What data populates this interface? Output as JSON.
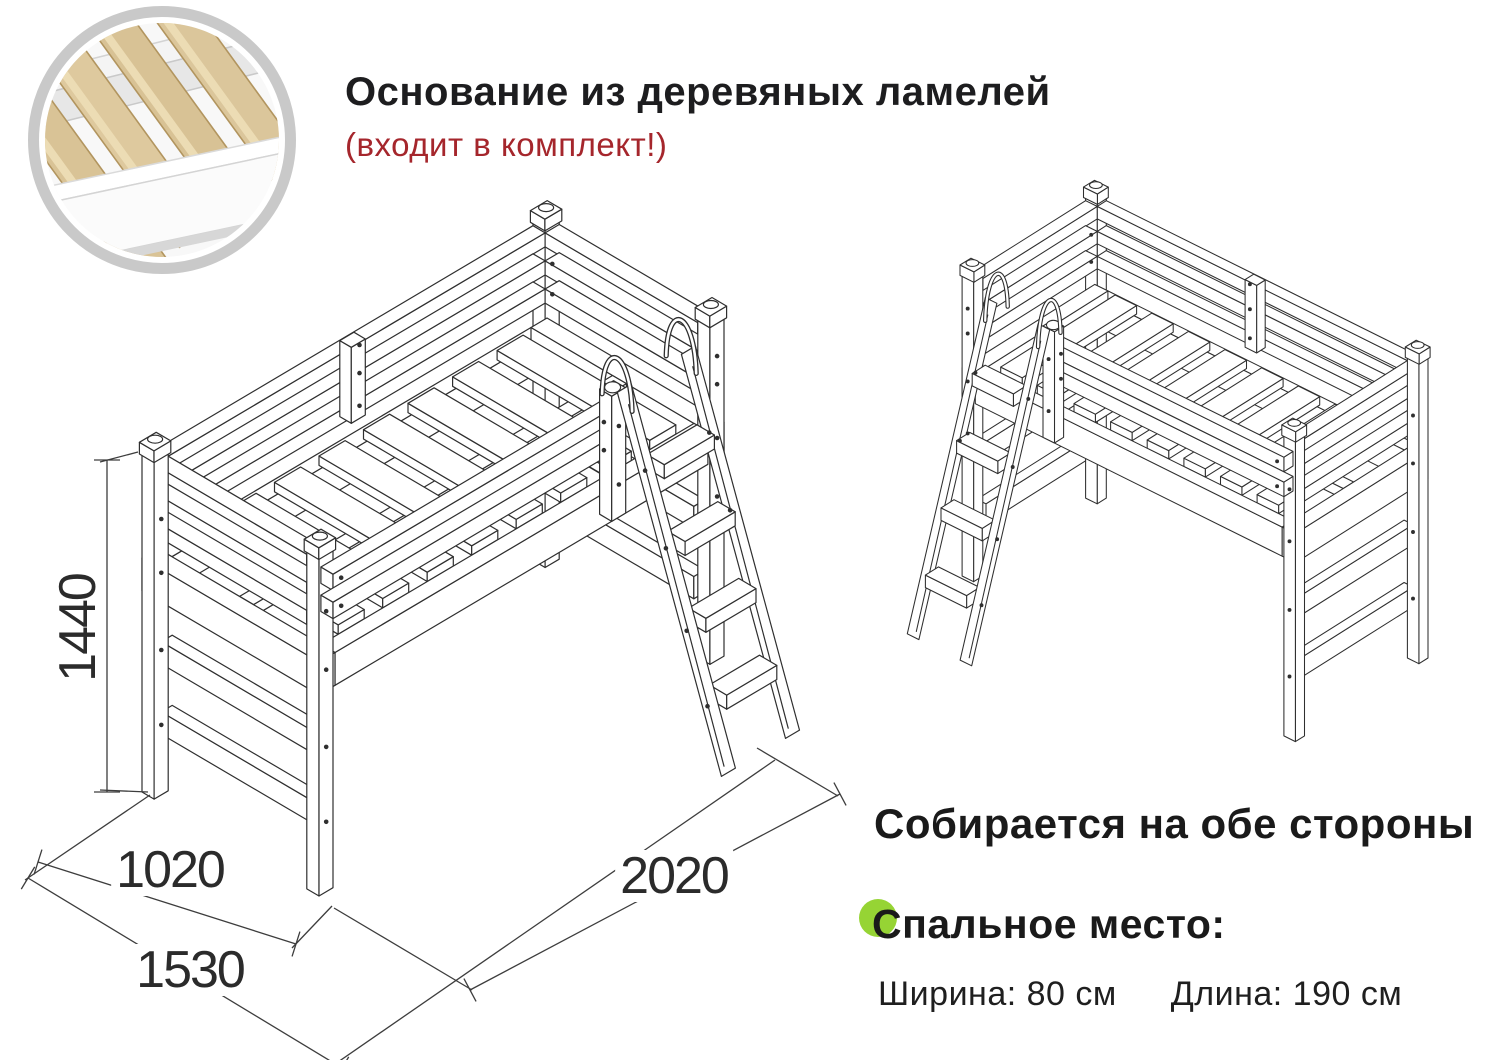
{
  "colors": {
    "accent_red": "#a5262c",
    "bullet_green": "#96d434",
    "drawing_line": "#2f2f2f"
  },
  "header": {
    "title": "Основание из деревяных ламелей",
    "subtitle": "(входит в комплект!)"
  },
  "inset": {
    "icon": "wood-slats-photo"
  },
  "dimensions": {
    "height_mm": "1440",
    "width_mm": "1020",
    "width_with_ladder_mm": "1530",
    "length_mm": "2020"
  },
  "notes": {
    "both_sides": "Собирается на обе стороны"
  },
  "sleeping_area": {
    "title": "Спальное место:",
    "width": "Ширина: 80 см",
    "length": "Длина: 190 см"
  }
}
